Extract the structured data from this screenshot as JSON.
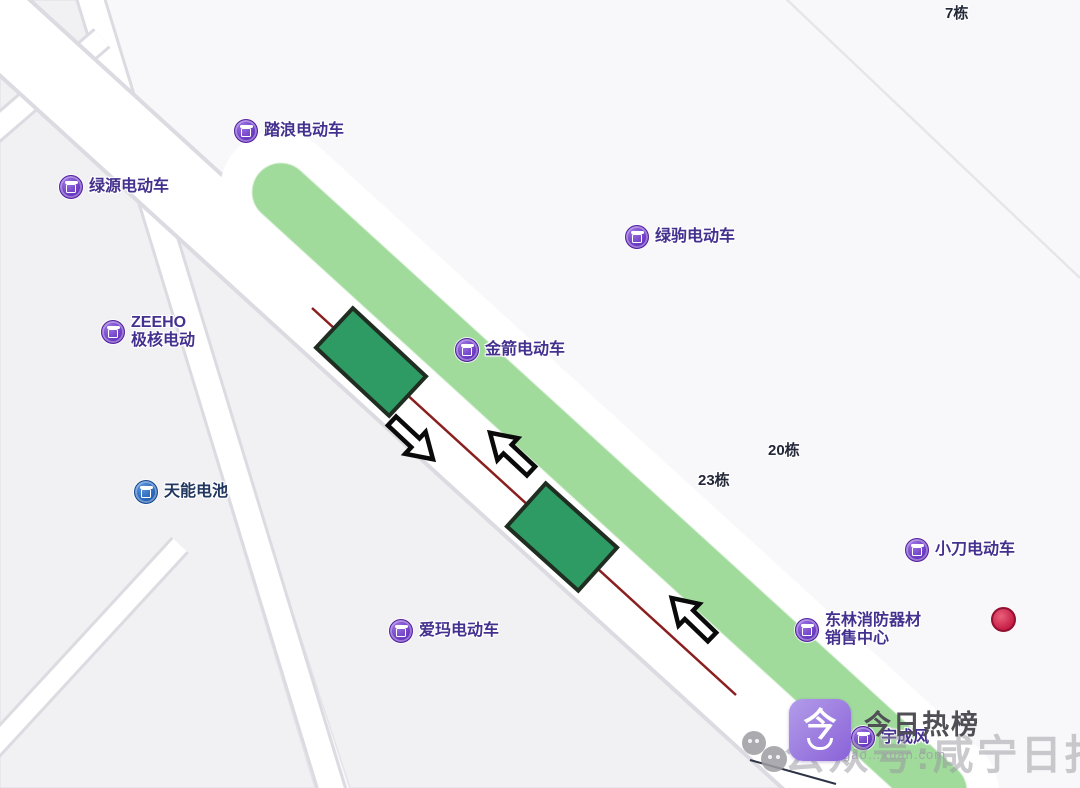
{
  "map": {
    "colors": {
      "background": "#f8f8fa",
      "block_gray": "#f1f1f4",
      "road_fill": "#ffffff",
      "road_casing": "#dbdbe1",
      "green_strip": "#a8dfa3",
      "building_fill": "#2e9b64",
      "building_border": "#202e22",
      "centerline_red": "#8b1e1e",
      "marker_purple": "#6231bd",
      "marker_blue": "#1f5cb0",
      "marker_text_purple": "#44308f",
      "marker_text_blue": "#21375f",
      "red_pin": "#c51a42"
    },
    "markers": [
      {
        "id": "talang",
        "type": "purple",
        "x": 245,
        "y": 130,
        "lines": [
          "踏浪电动车"
        ]
      },
      {
        "id": "lvyuan",
        "type": "purple",
        "x": 70,
        "y": 186,
        "lines": [
          "绿源电动车"
        ]
      },
      {
        "id": "zeeho",
        "type": "purple",
        "x": 112,
        "y": 333,
        "lines": [
          "ZEEHO",
          "极核电动"
        ]
      },
      {
        "id": "lvju",
        "type": "purple",
        "x": 636,
        "y": 236,
        "lines": [
          "绿驹电动车"
        ]
      },
      {
        "id": "jinjian",
        "type": "purple",
        "x": 466,
        "y": 349,
        "lines": [
          "金箭电动车"
        ]
      },
      {
        "id": "tianneng",
        "type": "blue",
        "x": 145,
        "y": 491,
        "lines": [
          "天能电池"
        ]
      },
      {
        "id": "aima",
        "type": "purple",
        "x": 400,
        "y": 630,
        "lines": [
          "爱玛电动车"
        ]
      },
      {
        "id": "xiaodao",
        "type": "purple",
        "x": 916,
        "y": 549,
        "lines": [
          "小刀电动车"
        ]
      },
      {
        "id": "donglin",
        "type": "purple",
        "x": 806,
        "y": 631,
        "lines": [
          "东林消防器材",
          "销售中心"
        ]
      },
      {
        "id": "yuchengfeng",
        "type": "purple",
        "x": 862,
        "y": 737,
        "lines": [
          "宇成风"
        ]
      }
    ],
    "building_labels": [
      {
        "text": "7栋",
        "x": 945,
        "y": 2
      },
      {
        "text": "20栋",
        "x": 768,
        "y": 439
      },
      {
        "text": "23栋",
        "x": 698,
        "y": 469
      }
    ]
  },
  "watermark": {
    "logo_char": "今",
    "title": "今日热榜",
    "faint_text": "公众号:咸宁日报",
    "url_text": "gao…xuan.com"
  }
}
